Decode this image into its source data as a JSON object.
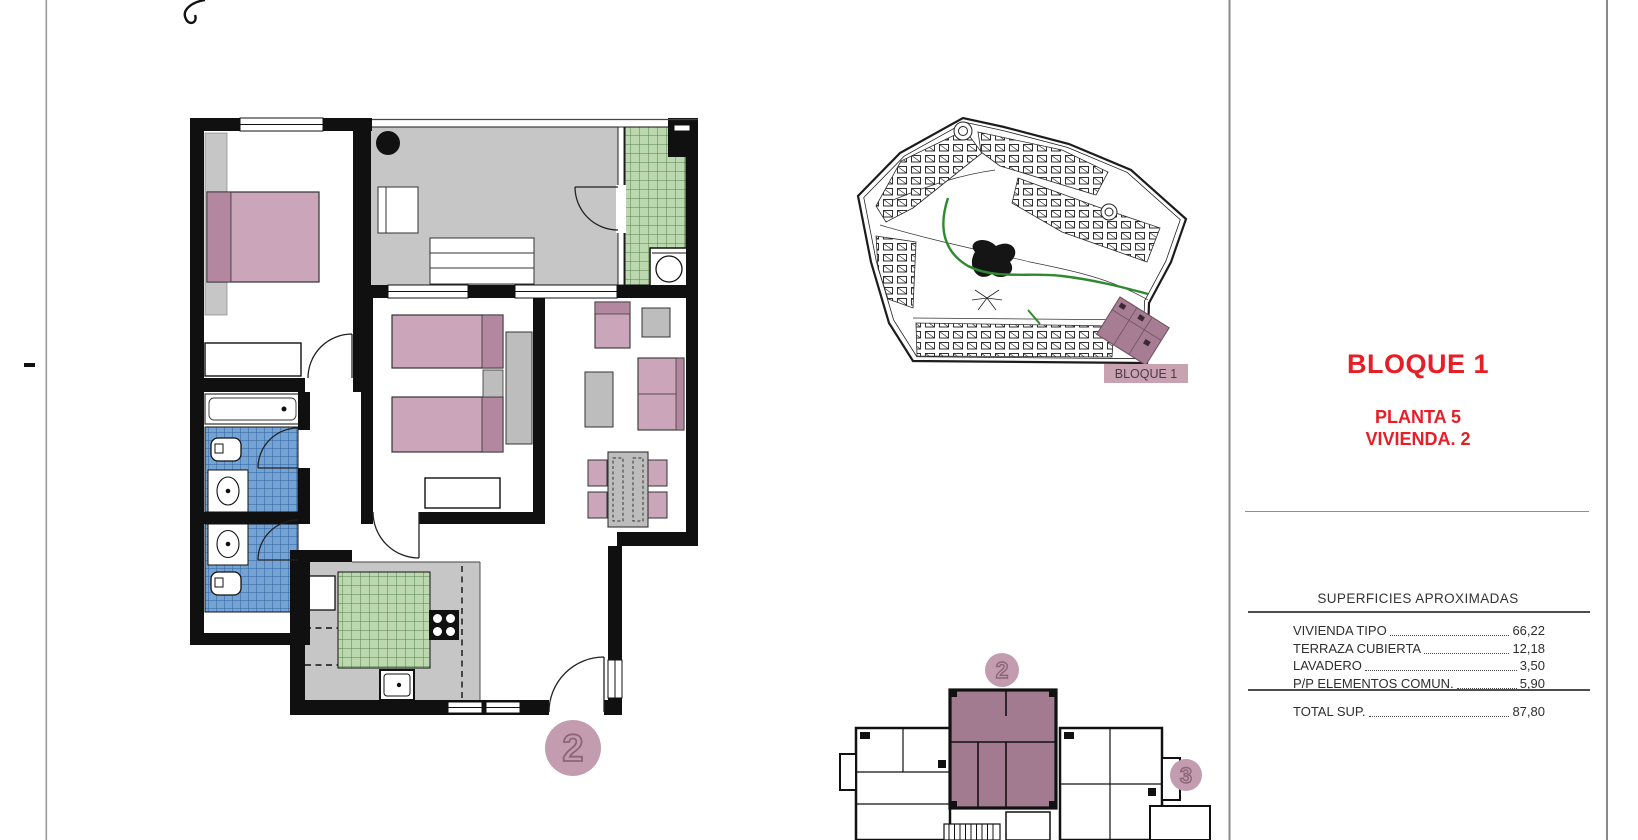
{
  "right_panel": {
    "title": "BLOQUE 1",
    "planta": "PLANTA 5",
    "vivienda": "VIVIENDA. 2",
    "surfaces_header": "SUPERFICIES APROXIMADAS",
    "rows": [
      {
        "label": "VIVIENDA TIPO",
        "value": "66,22"
      },
      {
        "label": "TERRAZA CUBIERTA",
        "value": "12,18"
      },
      {
        "label": "LAVADERO",
        "value": "3,50"
      },
      {
        "label": "P/P ELEMENTOS COMUN.",
        "value": "5,90"
      }
    ],
    "total_label": "TOTAL SUP.",
    "total_value": "87,80"
  },
  "site_plan": {
    "highlight_label": "BLOQUE 1"
  },
  "main_plan": {
    "unit_badge": "2"
  },
  "key_plan": {
    "unit_badge_2": "2",
    "unit_badge_3": "3"
  },
  "colors": {
    "accent_red": "#e61e25",
    "wall_black": "#101010",
    "furniture_pink": "#cba6ba",
    "furniture_pink_dark": "#b2879f",
    "highlight_mauve": "#a37b91",
    "badge_pink": "#c49cb0",
    "tile_green": "#bcd8ae",
    "tile_blue": "#74a3d4",
    "floor_gray": "#c6c6c6"
  }
}
